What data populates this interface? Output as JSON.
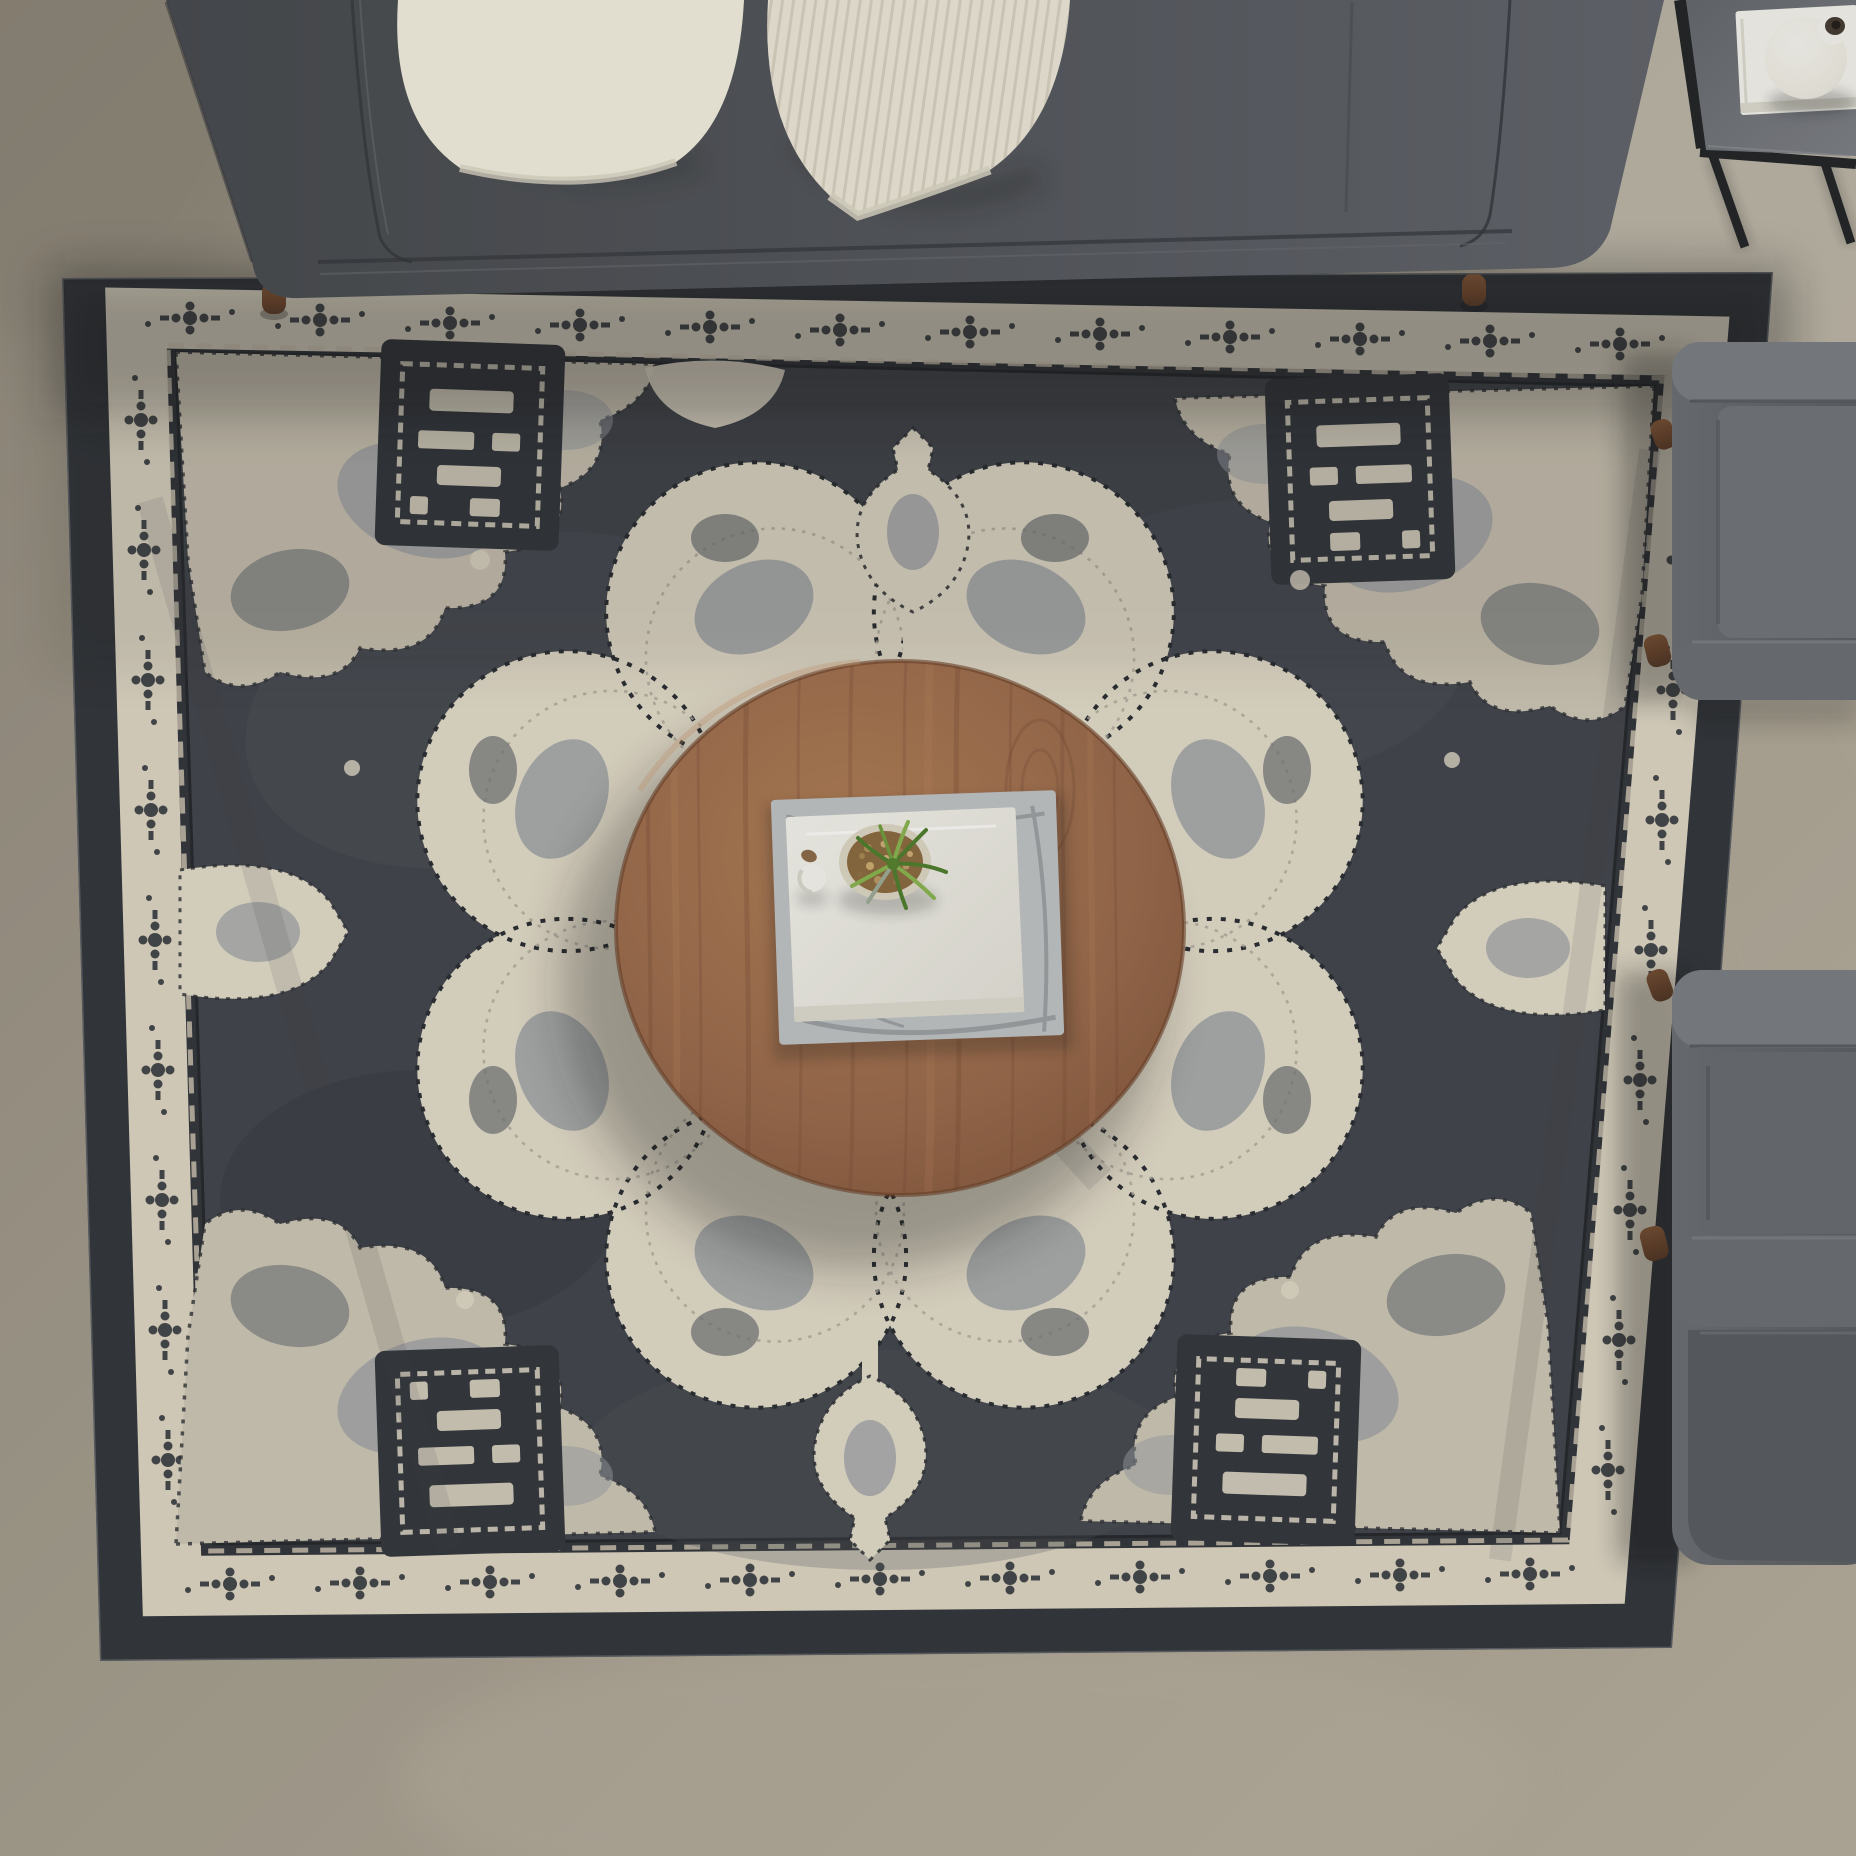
{
  "scene": {
    "title": "Top-down living room photograph",
    "description": "Overhead staged photo: charcoal fabric sofa with two cream throw pillows along the top, a large distressed charcoal-and-ivory oriental medallion area rug, a round walnut coffee table at center holding a white book on a marble tray with a pebble-filled bowl and green air plant, two gray upholstered armchairs entering from the right edge, and a black metal side table with a white book and white gourd vase at the top right, all on a greige concrete floor.",
    "objects": [
      {
        "name": "floor",
        "label": "greige concrete floor"
      },
      {
        "name": "area-rug",
        "label": "distressed vintage medallion rug, charcoal field with ivory border and medallion"
      },
      {
        "name": "sofa",
        "label": "charcoal upholstered sofa with walnut legs"
      },
      {
        "name": "pillow-plain",
        "label": "plain cream throw pillow"
      },
      {
        "name": "pillow-striped",
        "label": "striped textured cream throw pillow"
      },
      {
        "name": "coffee-table",
        "label": "round walnut coffee table"
      },
      {
        "name": "marble-tray",
        "label": "marble-print book / tray"
      },
      {
        "name": "white-book",
        "label": "white hardcover book"
      },
      {
        "name": "planter-bowl",
        "label": "cream bowl with pebbles"
      },
      {
        "name": "air-plant",
        "label": "green air plant"
      },
      {
        "name": "mini-pot",
        "label": "small white pot"
      },
      {
        "name": "armchair-top",
        "label": "gray armchair, upper right"
      },
      {
        "name": "armchair-bottom",
        "label": "gray armchair, lower right"
      },
      {
        "name": "side-table",
        "label": "black metal side table with gray top"
      },
      {
        "name": "side-table-book",
        "label": "white book on side table"
      },
      {
        "name": "vase",
        "label": "white gourd vase with dark mouth"
      }
    ]
  },
  "colors": {
    "floor_a": "#8e877a",
    "floor_b": "#a39c8d",
    "floor_c": "#b2aa99",
    "floor_light": "#c9c3b5",
    "rug_band": "#33363a",
    "rug_cream": "#d8d1bf",
    "rug_field": "#42454b",
    "rug_field_light": "#53565d",
    "rug_motif_dark": "#34373c",
    "rug_gray": "#989ca1",
    "rug_gray_dark": "#6c6f74",
    "med_cream": "#ddd6c4",
    "corner_cream": "#c9c2b1",
    "sofa_dark": "#46494d",
    "sofa_mid": "#54575c",
    "sofa_light": "#60636a",
    "sofa_seam": "#35383c",
    "pillow_plain": "#ece8da",
    "pillow_shade": "#d6d1c0",
    "pillow_stripe_base": "#e7e2d3",
    "pillow_stripe_line": "#c2bcaa",
    "wood_light": "#ad7c55",
    "wood_mid": "#96684a",
    "wood_dark": "#7c4f38",
    "wood_grain": "#6e4330",
    "book_white": "#efeee8",
    "book_page": "#d8d6cb",
    "marble": "#bcbfc0",
    "marble_vein": "#8e9296",
    "bowl_rim": "#d9d2c0",
    "bowl_soil": "#8a6a40",
    "pebble": "#b39260",
    "plant_dark": "#4e7d2e",
    "plant_light": "#86b14e",
    "chair_light": "#797c81",
    "chair_mid": "#6a6d72",
    "chair_dark": "#585b60",
    "leg_wood": "#4e3424",
    "leg_wood_hi": "#6f4b31",
    "metal": "#232527",
    "sidetable_top_a": "#7b7e83",
    "sidetable_top_b": "#63666b",
    "vase_white": "#f2f0ea",
    "vase_shade": "#d4d1c7",
    "vase_mouth": "#453b33",
    "shadow": "#141517"
  }
}
